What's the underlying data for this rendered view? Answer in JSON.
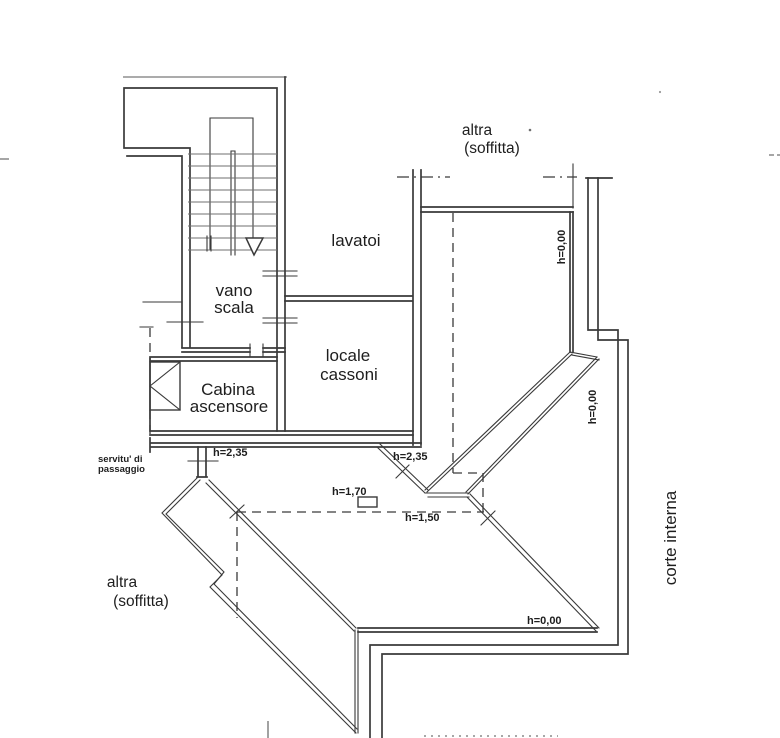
{
  "plan": {
    "labels": {
      "altra_top_1": "altra",
      "altra_top_2": "(soffitta)",
      "lavatoi": "lavatoi",
      "vano_1": "vano",
      "vano_2": "scala",
      "cassoni_1": "locale",
      "cassoni_2": "cassoni",
      "cabina_1": "Cabina",
      "cabina_2": "ascensore",
      "servitu_1": "servitu' di",
      "servitu_2": "passaggio",
      "altra_bottom_1": "altra",
      "altra_bottom_2": "(soffitta)",
      "corte": "corte interna"
    },
    "heights": {
      "door_left": "h=2,35",
      "wall_right": "h=2,35",
      "center": "h=1,70",
      "lower": "h=1,50",
      "room_right_top": "h=0,00",
      "room_right_mid": "h=0,00",
      "room_bottom": "h=0,00"
    },
    "colors": {
      "ink": "#3a3a3a",
      "paper": "#ffffff"
    }
  }
}
